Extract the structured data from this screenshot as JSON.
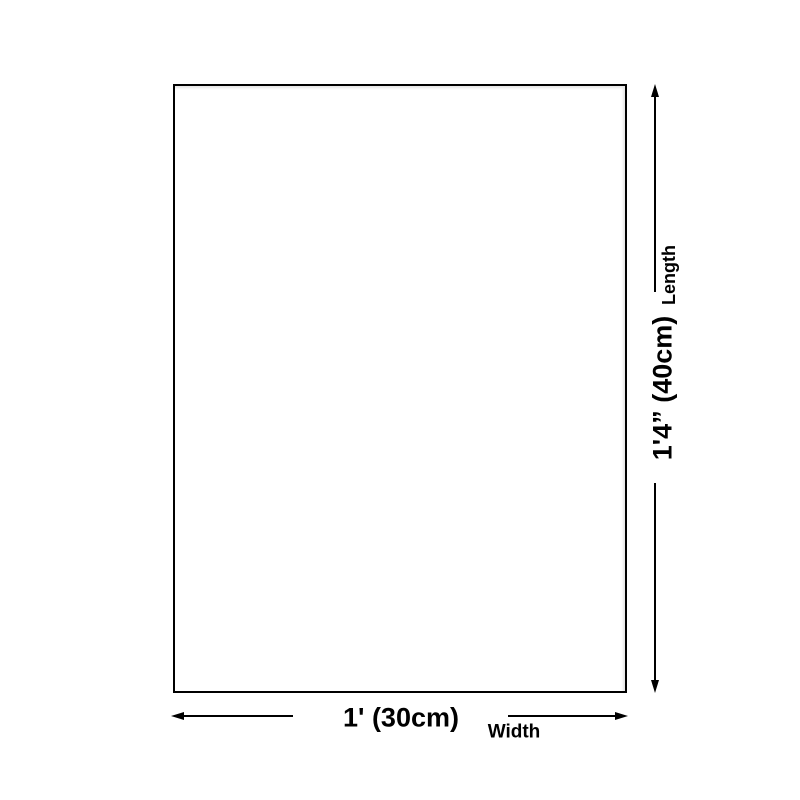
{
  "diagram": {
    "background_color": "#ffffff",
    "line_color": "#000000",
    "length": {
      "value": "1'4” (40cm)",
      "axis_label": "Length"
    },
    "width": {
      "value": "1' (30cm)",
      "axis_label": "Width"
    }
  }
}
